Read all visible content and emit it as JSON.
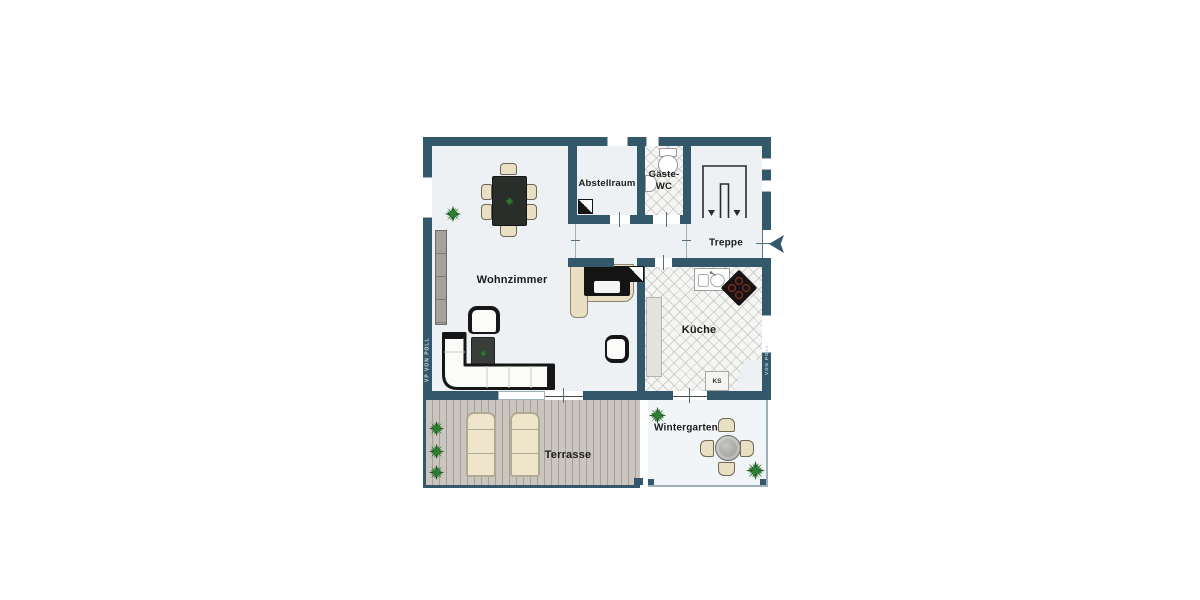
{
  "floorplan": {
    "rooms": {
      "wohnzimmer": {
        "label": "Wohnzimmer"
      },
      "abstellraum": {
        "label": "Abstellraum"
      },
      "gaeste_wc": {
        "label_line1": "Gäste-",
        "label_line2": "WC"
      },
      "treppe": {
        "label": "Treppe"
      },
      "kueche": {
        "label": "Küche",
        "fridge_abbr": "KS"
      },
      "terrasse": {
        "label": "Terrasse"
      },
      "wintergarten": {
        "label": "Wintergarten"
      }
    },
    "watermarks": {
      "left": "VP VON POLL",
      "right": "VON POLL"
    },
    "colors": {
      "wall": "#33586B",
      "floor": "#EDF1F4",
      "tile_floor": "#F5F5F3",
      "terrace_deck": "#CBC5BF",
      "beige": "#E9DFC3",
      "plant": "#2E7D32",
      "dark_furniture": "#2A2E2A"
    }
  }
}
